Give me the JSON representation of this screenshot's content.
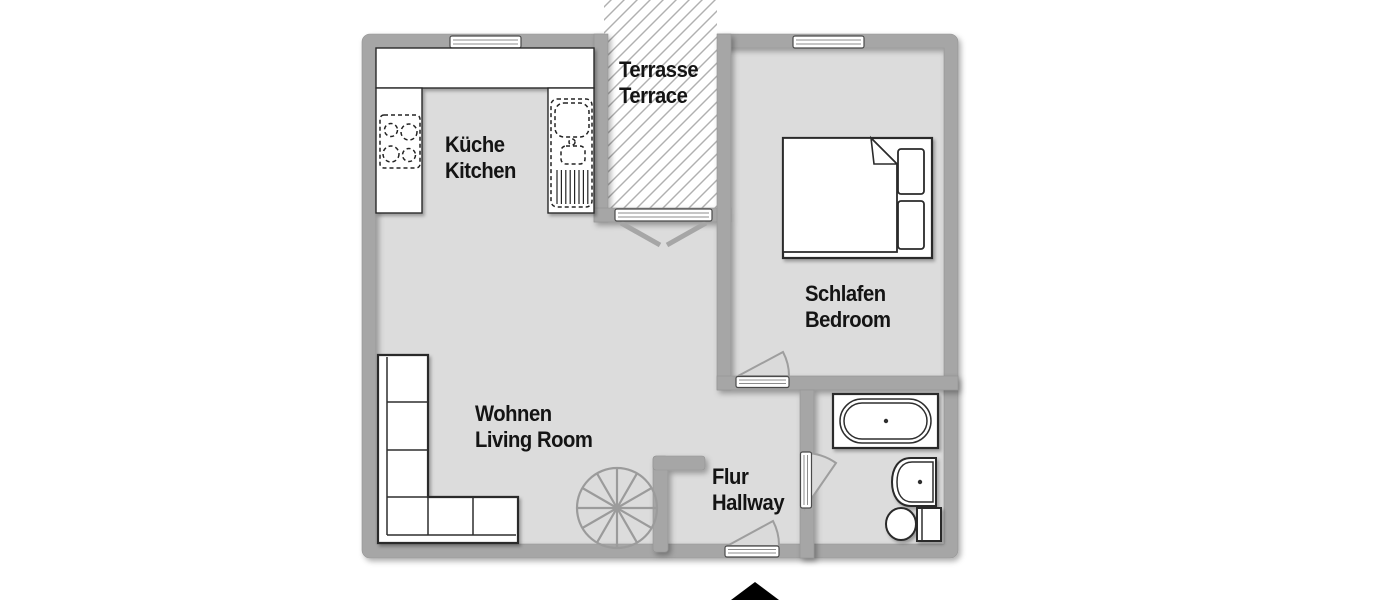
{
  "plan": {
    "type": "apartment-floor-plan",
    "rooms": {
      "terrace": {
        "label_de": "Terrasse",
        "label_en": "Terrace"
      },
      "kitchen": {
        "label_de": "Küche",
        "label_en": "Kitchen"
      },
      "bedroom": {
        "label_de": "Schlafen",
        "label_en": "Bedroom"
      },
      "living_room": {
        "label_de": "Wohnen",
        "label_en": "Living Room"
      },
      "hallway": {
        "label_de": "Flur",
        "label_en": "Hallway"
      }
    },
    "fixtures": [
      "stove",
      "kitchen-sink",
      "kitchen-counter",
      "sofa",
      "spiral-staircase",
      "double-bed",
      "pillows",
      "bathtub",
      "wash-basin",
      "toilet",
      "window",
      "door-swing",
      "terrace-double-door",
      "entrance-arrow"
    ],
    "colors": {
      "background": "#ffffff",
      "wall": "#a6a6a6",
      "floor": "#dcdcdc",
      "hatch": "#b0b0b0",
      "outline": "#1f1f1f",
      "stair": "#9b9b9b",
      "text": "#141414",
      "entrance_marker": "#000000"
    }
  }
}
